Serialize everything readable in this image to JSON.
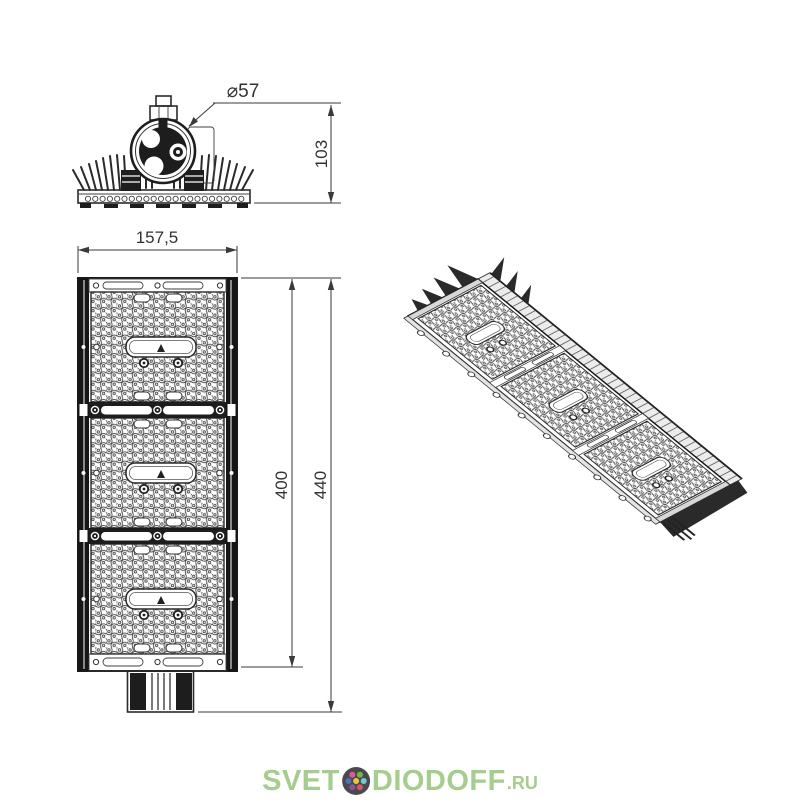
{
  "drawing": {
    "front_view": {
      "diameter": "⌀57",
      "height": "103"
    },
    "plan_view": {
      "width": "157,5",
      "body_length": "400",
      "overall_length": "440"
    },
    "colors": {
      "line": "#2a2a2a",
      "fill_dark": "#1d1d1d",
      "background": "#ffffff"
    }
  },
  "watermark": {
    "text_before_icon": "SVET",
    "text_after_icon": "DIODOFF",
    "domain_suffix": ".RU",
    "text_color": "#a5cd8d",
    "icon": {
      "bg": "#4a4a4a",
      "dots": [
        "#e05a92",
        "#76b649",
        "#4a72b8",
        "#e3c93e",
        "#79c7dc",
        "#8a52a0",
        "#d5566b"
      ]
    }
  }
}
